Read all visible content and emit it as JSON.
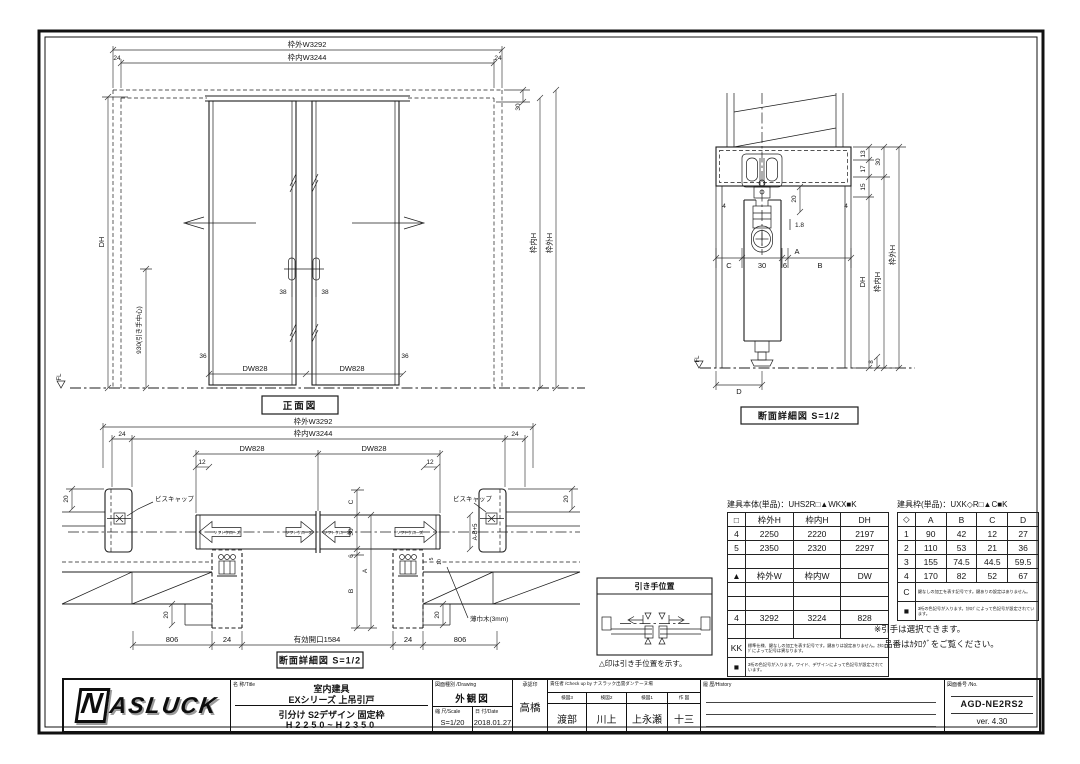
{
  "colors": {
    "ink": "#1c1c1c",
    "paper": "#ffffff"
  },
  "front_view": {
    "caption": "正面図",
    "dim_outer_w": "枠外W3292",
    "dim_inner_w": "枠内W3244",
    "dim_24": "24",
    "dim_30": "30",
    "dim_dh": "DH",
    "dim_handle_center": "930(引き手中心)",
    "fl": "FL",
    "dim_36": "36",
    "dim_dw": "DW828",
    "dim_38": "38",
    "dim_inner_h": "枠内H",
    "dim_outer_h": "枠外H"
  },
  "section_view": {
    "caption": "断面詳細図 S=1/2",
    "d13": "13",
    "d17": "17",
    "d15": "15",
    "d30": "30",
    "d20": "20",
    "d4": "4",
    "d1_8": "1.8",
    "dA": "A",
    "dB": "B",
    "dC": "C",
    "d30b": "30",
    "d6": "6",
    "d8": "8",
    "dD": "D",
    "dh": "DH",
    "inner_h": "枠内H",
    "outer_h": "枠外H",
    "fl": "FL"
  },
  "plan_view": {
    "caption": "断面詳細図 S=1/2",
    "dim_outer_w": "枠外W3292",
    "dim_inner_w": "枠内W3244",
    "dim_24": "24",
    "dim_dw": "DW828",
    "d12": "12",
    "d20": "20",
    "screw_cap": "ビスキャップ",
    "soft_close": "ソフトクローズ",
    "dC": "C",
    "d30": "30",
    "d6": "6",
    "dA": "A",
    "dB": "B",
    "d_ab5": "A-B+5",
    "d5": "5",
    "d10": "10",
    "skirting": "薄巾木(3mm)",
    "d806": "806",
    "d24b": "24",
    "opening": "有効開口1584"
  },
  "handle_box": {
    "title": "引き手位置",
    "note": "△印は引き手位置を示す。"
  },
  "tables": {
    "body": {
      "title": "建具本体(単品)：UHS2R□▲WKX■K",
      "h": [
        "□",
        "枠外H",
        "枠内H",
        "DH"
      ],
      "r1": [
        "4",
        "2250",
        "2220",
        "2197"
      ],
      "r2": [
        "5",
        "2350",
        "2320",
        "2297"
      ],
      "h2": [
        "▲",
        "枠外W",
        "枠内W",
        "DW"
      ],
      "r3": [
        "4",
        "3292",
        "3224",
        "828"
      ],
      "kk_label": "KK",
      "kk_note": "標準仕様、鍵なしの加工を表す記号です。鍵ありは設定ありません。ｶﾀﾛｸﾞによって記号は異なります。",
      "sq_label": "■",
      "sq_note": "3桁の色記号が入ります。ワイド、デザインによって色記号が設定されています。"
    },
    "frame": {
      "title": "建具枠(単品)：UXK◇R□▲C■K",
      "h": [
        "◇",
        "A",
        "B",
        "C",
        "D"
      ],
      "r1": [
        "1",
        "90",
        "42",
        "12",
        "27"
      ],
      "r2": [
        "2",
        "110",
        "53",
        "21",
        "36"
      ],
      "r3": [
        "3",
        "155",
        "74.5",
        "44.5",
        "59.5"
      ],
      "r4": [
        "4",
        "170",
        "82",
        "52",
        "67"
      ],
      "c_label": "C",
      "c_note": "鍵なしの加工を表す記号です。鍵ありの設定はありません。",
      "sq_label": "■",
      "sq_note": "3桁の色記号が入ります。ｶﾀﾛｸﾞによって色記号が設定されています。"
    },
    "footnote1": "※引手は選択できます。",
    "footnote2": "品番はｶﾀﾛｸﾞをご覧ください。"
  },
  "title_block": {
    "logo_n": "N",
    "logo_rest": "ASLUCK",
    "name_label": "名 称/Title",
    "name_line1": "室内建具",
    "name_line2": "EXシリーズ 上吊引戸",
    "name_line3": "引分け S2デザイン 固定枠",
    "name_line4": "H2250~H2350",
    "drawing_label": "図面種別 /Drawing",
    "drawing_type": "外観図",
    "scale_label": "縮 尺/Scale",
    "scale_value": "S=1/20",
    "date_label": "日 付/Date",
    "date_value": "2018.01.27",
    "approval_label": "承認印",
    "approval_name": "高橋",
    "check_header": "責任者 /Check up by ナスラック出雲ダンテーヌ場",
    "check3_label": "検図3",
    "check3_name": "渡部",
    "check2_label": "検図2",
    "check2_name": "川上",
    "check1_label": "検図1",
    "check1_name": "上永瀬",
    "sakuzu_label": "作 図",
    "sakuzu_name": "十三",
    "history_label": "履 歴/History",
    "number_label": "図面番号 /No.",
    "number_value": "AGD-NE2RS2",
    "version_value": "ver. 4.30"
  }
}
